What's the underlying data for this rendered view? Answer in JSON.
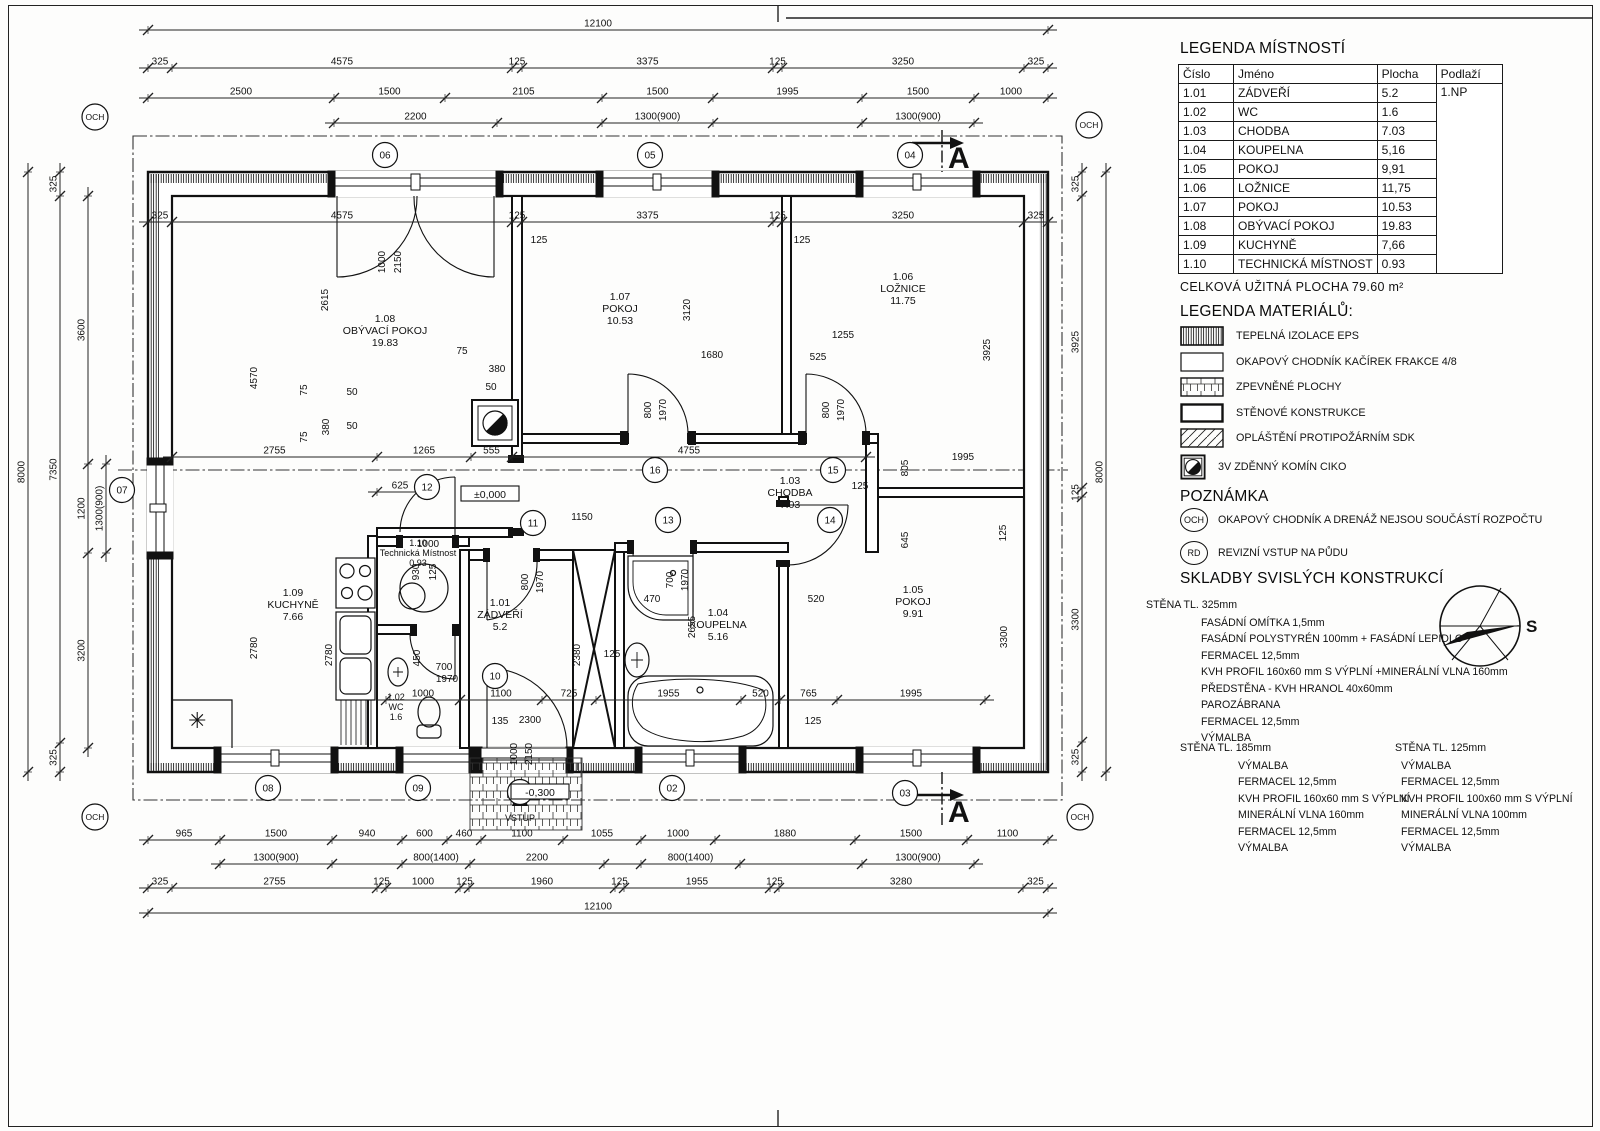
{
  "legend_rooms": {
    "title": "LEGENDA MÍSTNOSTÍ",
    "headers": [
      "Číslo",
      "Jméno",
      "Plocha",
      "Podlaží"
    ],
    "floor": "1.NP",
    "rows": [
      [
        "1.01",
        "ZÁDVEŘÍ",
        "5.2"
      ],
      [
        "1.02",
        "WC",
        "1.6"
      ],
      [
        "1.03",
        "CHODBA",
        "7.03"
      ],
      [
        "1.04",
        "KOUPELNA",
        "5,16"
      ],
      [
        "1.05",
        "POKOJ",
        "9,91"
      ],
      [
        "1.06",
        "LOŽNICE",
        "11,75"
      ],
      [
        "1.07",
        "POKOJ",
        "10.53"
      ],
      [
        "1.08",
        "OBÝVACÍ POKOJ",
        "19.83"
      ],
      [
        "1.09",
        "KUCHYNĚ",
        "7,66"
      ],
      [
        "1.10",
        "TECHNICKÁ MÍSTNOST",
        "0.93"
      ]
    ],
    "total": "CELKOVÁ UŽITNÁ PLOCHA 79.60 m²"
  },
  "legend_materials": {
    "title": "LEGENDA MATERIÁLŮ:",
    "items": [
      {
        "swatch": "insulation",
        "label": "TEPELNÁ IZOLACE EPS"
      },
      {
        "swatch": "plain",
        "label": "OKAPOVÝ CHODNÍK KAČÍREK FRAKCE 4/8"
      },
      {
        "swatch": "grid",
        "label": "ZPEVNĚNÉ PLOCHY"
      },
      {
        "swatch": "wall",
        "label": "STĚNOVÉ KONSTRUKCE"
      },
      {
        "swatch": "diag",
        "label": "OPLÁŠTĚNÍ PROTIPOŽÁRNÍM SDK"
      },
      {
        "swatch": "chimney",
        "label": "3V ZDĚNNÝ KOMÍN CIKO"
      }
    ]
  },
  "notes": {
    "title": "POZNÁMKA",
    "items": [
      {
        "badge": "OCH",
        "text": "OKAPOVÝ CHODNÍK A DRENÁŽ NEJSOU SOUČÁSTÍ ROZPOČTU"
      },
      {
        "badge": "RD",
        "text": "REVIZNÍ VSTUP NA PŮDU"
      }
    ]
  },
  "compositions": {
    "title": "SKLADBY SVISLÝCH KONSTRUKCÍ",
    "walls": [
      {
        "name": "STĚNA TL. 325mm",
        "layers": [
          "FASÁDNÍ OMÍTKA 1,5mm",
          "FASÁDNÍ POLYSTYRÉN 100mm + FASÁDNÍ LEPIDLO",
          "FERMACEL 12,5mm",
          "KVH PROFIL 160x60 mm S VÝPLNÍ +MINERÁLNÍ VLNA 160mm",
          "PŘEDSTĚNA - KVH HRANOL 40x60mm",
          "PAROZÁBRANA",
          "FERMACEL 12,5mm",
          "VÝMALBA"
        ]
      },
      {
        "name": "STĚNA TL. 185mm",
        "layers": [
          "VÝMALBA",
          "FERMACEL 12,5mm",
          "KVH PROFIL 160x60 mm S VÝPLNÍ",
          "MINERÁLNÍ VLNA 160mm",
          "FERMACEL 12,5mm",
          "VÝMALBA"
        ]
      },
      {
        "name": "STĚNA TL. 125mm",
        "layers": [
          "VÝMALBA",
          "FERMACEL 12,5mm",
          "KVH PROFIL 100x60 mm S VÝPLNÍ",
          "MINERÁLNÍ VLNA 100mm",
          "FERMACEL 12,5mm",
          "VÝMALBA"
        ]
      }
    ]
  },
  "compass": {
    "label": "S"
  },
  "plan": {
    "section_label": "A",
    "entrance_label": "VSTUP",
    "levels": [
      {
        "x": 490,
        "y": 497,
        "t": "±0,000"
      },
      {
        "x": 540,
        "y": 795,
        "t": "-0,300"
      }
    ],
    "och_label": "OCH",
    "och": [
      {
        "x": 95,
        "y": 117
      },
      {
        "x": 1089,
        "y": 125
      },
      {
        "x": 95,
        "y": 817
      },
      {
        "x": 1080,
        "y": 817
      }
    ],
    "markers": [
      {
        "x": 520,
        "y": 792,
        "t": "01"
      },
      {
        "x": 672,
        "y": 788,
        "t": "02"
      },
      {
        "x": 905,
        "y": 793,
        "t": "03"
      },
      {
        "x": 910,
        "y": 155,
        "t": "04"
      },
      {
        "x": 650,
        "y": 155,
        "t": "05"
      },
      {
        "x": 385,
        "y": 155,
        "t": "06"
      },
      {
        "x": 122,
        "y": 490,
        "t": "07"
      },
      {
        "x": 268,
        "y": 788,
        "t": "08"
      },
      {
        "x": 418,
        "y": 788,
        "t": "09"
      },
      {
        "x": 495,
        "y": 676,
        "t": "10"
      },
      {
        "x": 533,
        "y": 523,
        "t": "11"
      },
      {
        "x": 427,
        "y": 487,
        "t": "12"
      },
      {
        "x": 668,
        "y": 520,
        "t": "13"
      },
      {
        "x": 830,
        "y": 520,
        "t": "14"
      },
      {
        "x": 833,
        "y": 470,
        "t": "15"
      },
      {
        "x": 655,
        "y": 470,
        "t": "16"
      }
    ],
    "rooms": [
      {
        "x": 385,
        "y": 322,
        "num": "1.08",
        "name": "OBÝVACÍ POKOJ",
        "area": "19.83"
      },
      {
        "x": 620,
        "y": 300,
        "num": "1.07",
        "name": "POKOJ",
        "area": "10.53"
      },
      {
        "x": 903,
        "y": 280,
        "num": "1.06",
        "name": "LOŽNICE",
        "area": "11.75"
      },
      {
        "x": 790,
        "y": 484,
        "num": "1.03",
        "name": "CHODBA",
        "area": "7.03"
      },
      {
        "x": 293,
        "y": 596,
        "num": "1.09",
        "name": "KUCHYNĚ",
        "area": "7.66"
      },
      {
        "x": 500,
        "y": 606,
        "num": "1.01",
        "name": "ZÁDVEŘÍ",
        "area": "5.2"
      },
      {
        "x": 718,
        "y": 616,
        "num": "1.04",
        "name": "KOUPELNA",
        "area": "5.16"
      },
      {
        "x": 913,
        "y": 593,
        "num": "1.05",
        "name": "POKOJ",
        "area": "9.91"
      },
      {
        "x": 396,
        "y": 700,
        "num": "1.02",
        "name": "WC",
        "area": "1.6",
        "s": 1
      },
      {
        "x": 418,
        "y": 546,
        "num": "1.10",
        "name": "Technická Místnost",
        "area": "0.93",
        "s": 1
      }
    ],
    "dims": [
      {
        "o": "h",
        "p": 30,
        "c": [
          148,
          1048
        ],
        "l": [
          "12100"
        ]
      },
      {
        "o": "h",
        "p": 68,
        "c": [
          148,
          172,
          512,
          522,
          773,
          782,
          1024,
          1048
        ],
        "l": [
          "325",
          "4575",
          "125",
          "3375",
          "125",
          "3250",
          "325"
        ]
      },
      {
        "o": "h",
        "p": 98,
        "c": [
          148,
          334,
          445,
          602,
          713,
          862,
          974,
          1048
        ],
        "l": [
          "2500",
          "1500",
          "2105",
          "1500",
          "1995",
          "1500",
          "1000"
        ]
      },
      {
        "o": "h",
        "p": 123,
        "c": [
          334,
          497,
          602,
          713,
          862,
          974
        ],
        "l": [
          "2200",
          "",
          "1300(900)",
          "",
          "1300(900)"
        ]
      },
      {
        "o": "h",
        "p": 222,
        "c": [
          148,
          172,
          512,
          522,
          773,
          782,
          1024,
          1048
        ],
        "l": [
          "325",
          "4575",
          "125",
          "3375",
          "125",
          "3250",
          "325"
        ]
      },
      {
        "o": "h",
        "p": 457,
        "c": [
          172,
          377,
          471,
          512,
          866
        ],
        "l": [
          "2755",
          "1265",
          "555",
          "4755"
        ]
      },
      {
        "o": "h",
        "p": 492,
        "c": [
          377,
          423
        ],
        "l": [
          "625"
        ]
      },
      {
        "o": "h",
        "p": 700,
        "c": [
          386,
          460,
          542,
          596,
          741,
          780,
          837,
          985
        ],
        "l": [
          "1000",
          "1100",
          "725",
          "1955",
          "520",
          "765",
          "1995"
        ]
      },
      {
        "o": "h",
        "p": 840,
        "c": [
          148,
          220,
          332,
          402,
          447,
          481,
          563,
          641,
          715,
          855,
          967,
          1048
        ],
        "l": [
          "965",
          "1500",
          "940",
          "600",
          "460",
          "1100",
          "1055",
          "1000",
          "1880",
          "1500",
          "1100"
        ]
      },
      {
        "o": "h",
        "p": 864,
        "c": [
          220,
          332,
          402,
          470,
          604,
          641,
          740,
          862,
          974
        ],
        "l": [
          "1300(900)",
          "",
          "800(1400)",
          "2200",
          "",
          "800(1400)",
          "",
          "1300(900)"
        ]
      },
      {
        "o": "h",
        "p": 888,
        "c": [
          148,
          172,
          377,
          386,
          460,
          469,
          615,
          624,
          770,
          779,
          1023,
          1048
        ],
        "l": [
          "325",
          "2755",
          "125",
          "1000",
          "125",
          "1960",
          "125",
          "1955",
          "125",
          "3280",
          "325"
        ]
      },
      {
        "o": "h",
        "p": 913,
        "c": [
          148,
          1048
        ],
        "l": [
          "12100"
        ]
      },
      {
        "o": "v",
        "p": 28,
        "c": [
          172,
          772
        ],
        "l": [
          "8000"
        ]
      },
      {
        "o": "v",
        "p": 60,
        "c": [
          172,
          196,
          743,
          772
        ],
        "l": [
          "325",
          "7350",
          "325"
        ]
      },
      {
        "o": "v",
        "p": 88,
        "c": [
          196,
          464,
          553,
          748
        ],
        "l": [
          "3600",
          "1200",
          "3200"
        ]
      },
      {
        "o": "v",
        "p": 106,
        "c": [
          464,
          553
        ],
        "l": [
          "1300(900)"
        ]
      },
      {
        "o": "v",
        "p": 1082,
        "c": [
          172,
          196,
          488,
          497,
          742,
          772
        ],
        "l": [
          "325",
          "3925",
          "125",
          "3300",
          "325"
        ]
      },
      {
        "o": "v",
        "p": 1106,
        "c": [
          172,
          772
        ],
        "l": [
          "8000"
        ]
      }
    ],
    "texts": [
      {
        "x": 328,
        "y": 300,
        "t": "2615",
        "r": -90
      },
      {
        "x": 257,
        "y": 378,
        "t": "4570",
        "r": -90
      },
      {
        "x": 690,
        "y": 310,
        "t": "3120",
        "r": -90
      },
      {
        "x": 990,
        "y": 350,
        "t": "3925",
        "r": -90
      },
      {
        "x": 843,
        "y": 338,
        "t": "1255"
      },
      {
        "x": 712,
        "y": 358,
        "t": "1680"
      },
      {
        "x": 818,
        "y": 360,
        "t": "525"
      },
      {
        "x": 539,
        "y": 243,
        "t": "125"
      },
      {
        "x": 802,
        "y": 243,
        "t": "125"
      },
      {
        "x": 385,
        "y": 262,
        "t": "1000",
        "r": -90
      },
      {
        "x": 401,
        "y": 262,
        "t": "2150",
        "r": -90
      },
      {
        "x": 651,
        "y": 410,
        "t": "800",
        "r": -90
      },
      {
        "x": 666,
        "y": 410,
        "t": "1970",
        "r": -90
      },
      {
        "x": 829,
        "y": 410,
        "t": "800",
        "r": -90
      },
      {
        "x": 844,
        "y": 410,
        "t": "1970",
        "r": -90
      },
      {
        "x": 908,
        "y": 468,
        "t": "805",
        "r": -90
      },
      {
        "x": 963,
        "y": 460,
        "t": "1995"
      },
      {
        "x": 860,
        "y": 489,
        "t": "125"
      },
      {
        "x": 908,
        "y": 540,
        "t": "645",
        "r": -90
      },
      {
        "x": 1006,
        "y": 533,
        "t": "125",
        "r": -90
      },
      {
        "x": 652,
        "y": 602,
        "t": "470"
      },
      {
        "x": 816,
        "y": 602,
        "t": "520"
      },
      {
        "x": 582,
        "y": 520,
        "t": "1150"
      },
      {
        "x": 612,
        "y": 657,
        "t": "125"
      },
      {
        "x": 695,
        "y": 627,
        "t": "2655",
        "r": -90
      },
      {
        "x": 1007,
        "y": 637,
        "t": "3300",
        "r": -90
      },
      {
        "x": 257,
        "y": 648,
        "t": "2780",
        "r": -90
      },
      {
        "x": 332,
        "y": 655,
        "t": "2780",
        "r": -90
      },
      {
        "x": 673,
        "y": 580,
        "t": "700",
        "r": -90
      },
      {
        "x": 688,
        "y": 580,
        "t": "1970",
        "r": -90
      },
      {
        "x": 528,
        "y": 582,
        "t": "800",
        "r": -90
      },
      {
        "x": 543,
        "y": 582,
        "t": "1970",
        "r": -90
      },
      {
        "x": 580,
        "y": 655,
        "t": "2380",
        "r": -90
      },
      {
        "x": 444,
        "y": 670,
        "t": "700"
      },
      {
        "x": 447,
        "y": 682,
        "t": "1970"
      },
      {
        "x": 420,
        "y": 658,
        "t": "450",
        "r": -90
      },
      {
        "x": 500,
        "y": 724,
        "t": "135"
      },
      {
        "x": 530,
        "y": 723,
        "t": "2300"
      },
      {
        "x": 517,
        "y": 754,
        "t": "1000",
        "r": -90
      },
      {
        "x": 532,
        "y": 754,
        "t": "2150",
        "r": -90
      },
      {
        "x": 813,
        "y": 724,
        "t": "125"
      },
      {
        "x": 307,
        "y": 390,
        "t": "75",
        "r": -90
      },
      {
        "x": 329,
        "y": 427,
        "t": "380",
        "r": -90
      },
      {
        "x": 352,
        "y": 395,
        "t": "50"
      },
      {
        "x": 307,
        "y": 437,
        "t": "75",
        "r": -90
      },
      {
        "x": 352,
        "y": 429,
        "t": "50"
      },
      {
        "x": 462,
        "y": 354,
        "t": "75"
      },
      {
        "x": 497,
        "y": 372,
        "t": "380"
      },
      {
        "x": 491,
        "y": 390,
        "t": "50"
      },
      {
        "x": 428,
        "y": 547,
        "t": "1000"
      },
      {
        "x": 419,
        "y": 572,
        "t": "930",
        "r": -90
      },
      {
        "x": 436,
        "y": 572,
        "t": "125",
        "r": -90
      }
    ]
  }
}
